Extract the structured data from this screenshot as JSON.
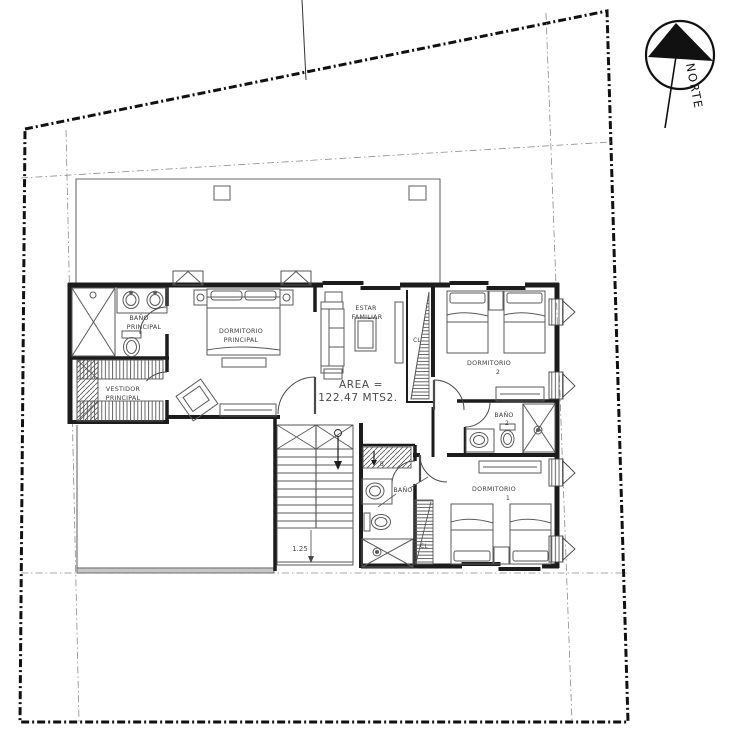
{
  "plan": {
    "title": "second-floor-plan",
    "north_label": "NORTE",
    "area": {
      "line1": "AREA =",
      "line2": "122.47 MTS2."
    },
    "rooms": {
      "bano_principal": {
        "line1": "BAÑO",
        "line2": "PRINCIPAL"
      },
      "vestidor_principal": {
        "line1": "VESTIDOR",
        "line2": "PRINCIPAL"
      },
      "dormitorio_principal": {
        "line1": "DORMITORIO",
        "line2": "PRINCIPAL"
      },
      "estar_familiar": {
        "line1": "ESTAR",
        "line2": "FAMILIAR"
      },
      "dormitorio_2": {
        "line1": "DORMITORIO",
        "line2": "2"
      },
      "bano_2": {
        "line1": "BAÑO",
        "line2": "2"
      },
      "dormitorio_1": {
        "line1": "DORMITORIO",
        "line2": "1"
      },
      "bano_servicio": {
        "line1": "BAÑO"
      },
      "closet_estar": {
        "label": "CL"
      },
      "closet_dormitorio_1": {
        "label": "CL"
      }
    },
    "stairs": {
      "dimension": "1.25",
      "down_label": "B"
    },
    "colors": {
      "boundary": "#111111",
      "wall": "#1c1c1c",
      "furniture": "#5a5a5a",
      "label": "#3c3c3c",
      "background": "#ffffff"
    }
  }
}
